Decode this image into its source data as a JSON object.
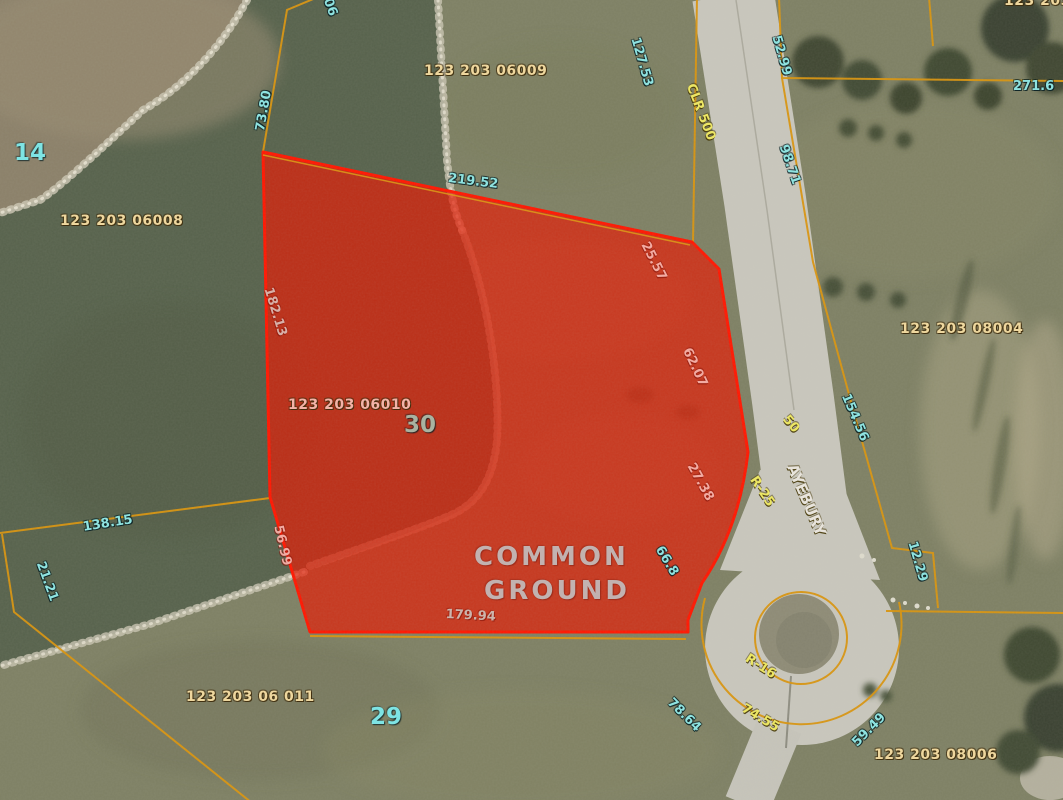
{
  "view": {
    "type": "aerial-parcel-map",
    "selected_parcel": {
      "lot_number": "30",
      "parcel_id": "123 203 06010",
      "designation": "COMMON GROUND",
      "highlight_fill": "#e51802",
      "highlight_border": "#ff1600"
    },
    "colors": {
      "boundary_line": "#d9940e",
      "dimension_text": "#8fe3e0",
      "parcel_id_text": "#eed79e",
      "road_text": "#ece664",
      "lot_text": "#7ee4e4",
      "road_surface": "#c9c7bd",
      "water": "#57624c",
      "grass": "#7e8064"
    }
  },
  "labels": {
    "lot_numbers": [
      {
        "t": "14",
        "x": 14,
        "y": 142,
        "r": 0
      },
      {
        "t": "30",
        "x": 404,
        "y": 414,
        "r": 0,
        "c": "#a9b2a0"
      },
      {
        "t": "29",
        "x": 370,
        "y": 706,
        "r": 0
      }
    ],
    "parcel_ids": [
      {
        "t": "123 203 06008",
        "x": 60,
        "y": 214,
        "r": 0
      },
      {
        "t": "123 203 06009",
        "x": 424,
        "y": 64,
        "r": 0
      },
      {
        "t": "123 203 08004",
        "x": 900,
        "y": 322,
        "r": 0
      },
      {
        "t": "123 203 06010",
        "x": 288,
        "y": 398,
        "r": 0,
        "c": "#f4b3a8"
      },
      {
        "t": "123 203 06 011",
        "x": 186,
        "y": 690,
        "r": 0
      },
      {
        "t": "123 203 08006",
        "x": 874,
        "y": 748,
        "r": 0
      },
      {
        "t": "123 203 0",
        "x": 1004,
        "y": -6,
        "r": 0
      }
    ],
    "dimensions": [
      {
        "t": "73.80",
        "x": 254,
        "y": 130,
        "r": -80
      },
      {
        "t": "306",
        "x": 330,
        "y": -12,
        "r": 70
      },
      {
        "t": "219.52",
        "x": 449,
        "y": 172,
        "r": 7
      },
      {
        "t": "127.53",
        "x": 641,
        "y": 36,
        "r": 74
      },
      {
        "t": "52.99",
        "x": 782,
        "y": 34,
        "r": 74
      },
      {
        "t": "271.6",
        "x": 1013,
        "y": 80,
        "r": 0
      },
      {
        "t": "98.71",
        "x": 789,
        "y": 143,
        "r": 71
      },
      {
        "t": "154.56",
        "x": 851,
        "y": 392,
        "r": 67
      },
      {
        "t": "138.15",
        "x": 82,
        "y": 521,
        "r": -9
      },
      {
        "t": "21.21",
        "x": 46,
        "y": 560,
        "r": 70
      },
      {
        "t": "12.29",
        "x": 918,
        "y": 540,
        "r": 74
      },
      {
        "t": "78.64",
        "x": 674,
        "y": 696,
        "r": 45
      },
      {
        "t": "59.49",
        "x": 850,
        "y": 740,
        "r": -45
      },
      {
        "t": "66.8",
        "x": 664,
        "y": 544,
        "r": 59
      }
    ],
    "dimensions_on_parcel": [
      {
        "t": "25.57",
        "x": 650,
        "y": 240,
        "r": 63
      },
      {
        "t": "62.07",
        "x": 692,
        "y": 346,
        "r": 65
      },
      {
        "t": "27.38",
        "x": 696,
        "y": 461,
        "r": 61
      },
      {
        "t": "56.99",
        "x": 284,
        "y": 524,
        "r": 77
      },
      {
        "t": "182.13",
        "x": 274,
        "y": 286,
        "r": 73,
        "c": "#d8b0a8"
      },
      {
        "t": "179.94",
        "x": 446,
        "y": 608,
        "r": 3,
        "c": "#ccb4ac"
      }
    ],
    "road_labels": [
      {
        "t": "CLR 500",
        "x": 696,
        "y": 82,
        "r": 69
      },
      {
        "t": "50",
        "x": 790,
        "y": 413,
        "r": 50
      },
      {
        "t": "R-25",
        "x": 758,
        "y": 474,
        "r": 56
      },
      {
        "t": "AYEBURY",
        "x": 798,
        "y": 462,
        "r": 67,
        "c": "#e8e4dc",
        "s": 15
      },
      {
        "t": "R-16",
        "x": 750,
        "y": 652,
        "r": 33
      },
      {
        "t": "74.55",
        "x": 746,
        "y": 702,
        "r": 31
      }
    ],
    "area_labels": [
      {
        "t": "COMMON",
        "x": 474,
        "y": 544,
        "r": 0
      },
      {
        "t": "GROUND",
        "x": 484,
        "y": 578,
        "r": 0
      }
    ]
  }
}
